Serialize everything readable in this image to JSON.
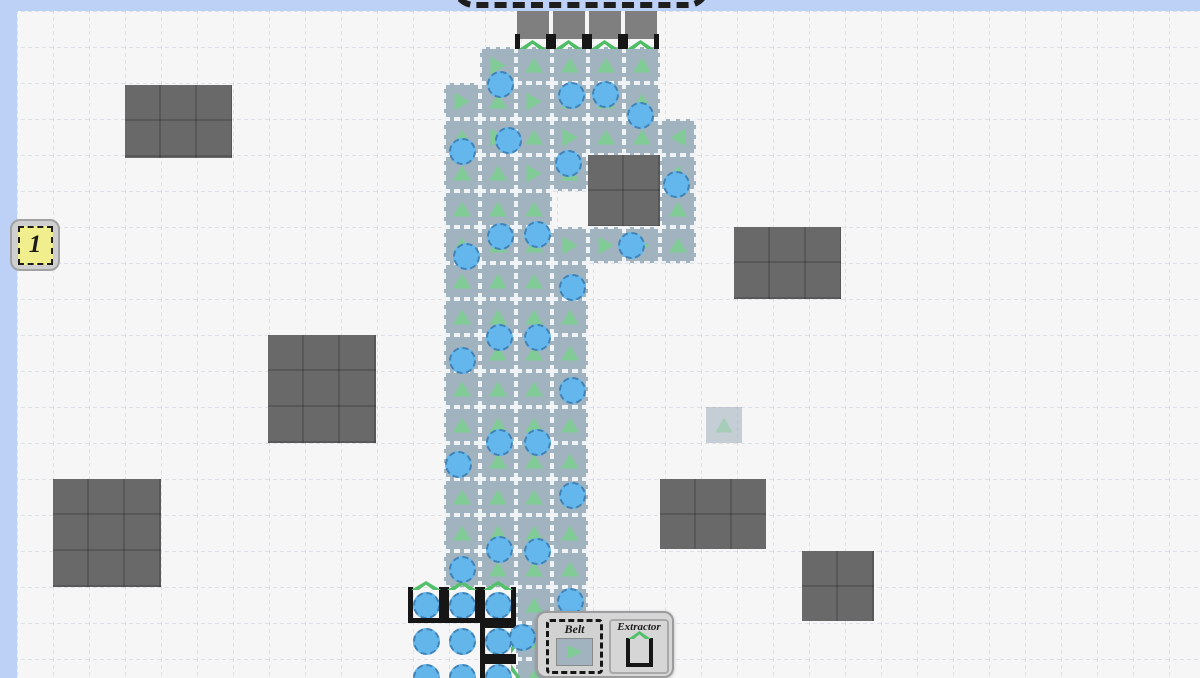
{
  "meta": {
    "tile_size": 36,
    "grid_origin_x": 17,
    "grid_origin_y": 11
  },
  "colors": {
    "margin_blue": "#bdd1f7",
    "field_bg": "#f6f6f7",
    "grid_line": "#c7cdd9",
    "belt": "#a0b3bf",
    "arrow_green": "#7ecd92",
    "item_blue": "#63b7ec",
    "obstacle_gray": "#696969",
    "port_gray": "#7f7f7f",
    "extractor_black": "#161616",
    "chevron_green": "#55c06b",
    "badge_yellow": "#f1ef8d"
  },
  "hud": {
    "level_badge": "1"
  },
  "toolbar": {
    "items": [
      {
        "label": "Belt",
        "selected": true,
        "icon": "belt-icon"
      },
      {
        "label": "Extractor",
        "selected": false,
        "icon": "extractor-icon"
      }
    ]
  },
  "hub": {
    "ports_x": [
      517,
      553,
      589,
      625
    ],
    "port_y": 11
  },
  "board": {
    "obstacles": [
      {
        "x": 125,
        "y": 85,
        "w": 107,
        "h": 73
      },
      {
        "x": 588,
        "y": 155,
        "w": 72,
        "h": 71
      },
      {
        "x": 734,
        "y": 227,
        "w": 107,
        "h": 72
      },
      {
        "x": 268,
        "y": 335,
        "w": 108,
        "h": 108
      },
      {
        "x": 53,
        "y": 479,
        "w": 108,
        "h": 108
      },
      {
        "x": 660,
        "y": 479,
        "w": 106,
        "h": 70
      },
      {
        "x": 802,
        "y": 551,
        "w": 72,
        "h": 70
      }
    ],
    "belts": [
      [
        480,
        47,
        "R"
      ],
      [
        516,
        47,
        "U"
      ],
      [
        552,
        47,
        "U"
      ],
      [
        588,
        47,
        "U"
      ],
      [
        624,
        47,
        "U"
      ],
      [
        444,
        83,
        "R"
      ],
      [
        480,
        83,
        "U"
      ],
      [
        516,
        83,
        "R"
      ],
      [
        552,
        83,
        "U"
      ],
      [
        588,
        83,
        "U"
      ],
      [
        624,
        83,
        "U"
      ],
      [
        444,
        119,
        "U"
      ],
      [
        480,
        119,
        "R"
      ],
      [
        516,
        119,
        "U"
      ],
      [
        552,
        119,
        "R"
      ],
      [
        588,
        119,
        "U"
      ],
      [
        624,
        119,
        "U"
      ],
      [
        660,
        119,
        "L"
      ],
      [
        444,
        155,
        "U"
      ],
      [
        480,
        155,
        "U"
      ],
      [
        516,
        155,
        "R"
      ],
      [
        552,
        155,
        "U"
      ],
      [
        660,
        155,
        "U"
      ],
      [
        444,
        191,
        "U"
      ],
      [
        480,
        191,
        "U"
      ],
      [
        516,
        191,
        "U"
      ],
      [
        660,
        191,
        "U"
      ],
      [
        444,
        227,
        "U"
      ],
      [
        480,
        227,
        "U"
      ],
      [
        516,
        227,
        "U"
      ],
      [
        552,
        227,
        "R"
      ],
      [
        588,
        227,
        "R"
      ],
      [
        624,
        227,
        "R"
      ],
      [
        660,
        227,
        "U"
      ],
      [
        444,
        263,
        "U"
      ],
      [
        480,
        263,
        "U"
      ],
      [
        516,
        263,
        "U"
      ],
      [
        552,
        263,
        "U"
      ],
      [
        444,
        299,
        "U"
      ],
      [
        480,
        299,
        "U"
      ],
      [
        516,
        299,
        "U"
      ],
      [
        552,
        299,
        "U"
      ],
      [
        444,
        335,
        "U"
      ],
      [
        480,
        335,
        "U"
      ],
      [
        516,
        335,
        "U"
      ],
      [
        552,
        335,
        "U"
      ],
      [
        444,
        371,
        "U"
      ],
      [
        480,
        371,
        "U"
      ],
      [
        516,
        371,
        "U"
      ],
      [
        552,
        371,
        "U"
      ],
      [
        444,
        407,
        "U"
      ],
      [
        480,
        407,
        "U"
      ],
      [
        516,
        407,
        "U"
      ],
      [
        552,
        407,
        "U"
      ],
      [
        444,
        443,
        "U"
      ],
      [
        480,
        443,
        "U"
      ],
      [
        516,
        443,
        "U"
      ],
      [
        552,
        443,
        "U"
      ],
      [
        444,
        479,
        "U"
      ],
      [
        480,
        479,
        "U"
      ],
      [
        516,
        479,
        "U"
      ],
      [
        552,
        479,
        "U"
      ],
      [
        444,
        515,
        "U"
      ],
      [
        480,
        515,
        "U"
      ],
      [
        516,
        515,
        "U"
      ],
      [
        552,
        515,
        "U"
      ],
      [
        444,
        551,
        "U"
      ],
      [
        480,
        551,
        "U"
      ],
      [
        516,
        551,
        "U"
      ],
      [
        552,
        551,
        "U"
      ],
      [
        516,
        587,
        "U"
      ],
      [
        552,
        587,
        "U"
      ],
      [
        516,
        623,
        "U"
      ],
      [
        552,
        623,
        "U"
      ],
      [
        516,
        659,
        "U"
      ],
      [
        552,
        659,
        "U"
      ]
    ],
    "items": [
      {
        "x": 500,
        "y": 84
      },
      {
        "x": 571,
        "y": 95
      },
      {
        "x": 605,
        "y": 94
      },
      {
        "x": 640,
        "y": 115
      },
      {
        "x": 508,
        "y": 140
      },
      {
        "x": 462,
        "y": 151
      },
      {
        "x": 568,
        "y": 163
      },
      {
        "x": 676,
        "y": 184
      },
      {
        "x": 631,
        "y": 245
      },
      {
        "x": 466,
        "y": 256
      },
      {
        "x": 500,
        "y": 236
      },
      {
        "x": 537,
        "y": 234
      },
      {
        "x": 572,
        "y": 287
      },
      {
        "x": 462,
        "y": 360
      },
      {
        "x": 499,
        "y": 337
      },
      {
        "x": 537,
        "y": 337
      },
      {
        "x": 572,
        "y": 390
      },
      {
        "x": 499,
        "y": 442
      },
      {
        "x": 537,
        "y": 442
      },
      {
        "x": 458,
        "y": 464
      },
      {
        "x": 572,
        "y": 495
      },
      {
        "x": 462,
        "y": 569
      },
      {
        "x": 499,
        "y": 549
      },
      {
        "x": 537,
        "y": 551
      },
      {
        "x": 570,
        "y": 601
      },
      {
        "x": 522,
        "y": 637
      }
    ],
    "resources": [
      {
        "x": 426,
        "y": 605
      },
      {
        "x": 462,
        "y": 605
      },
      {
        "x": 498,
        "y": 605
      },
      {
        "x": 426,
        "y": 641
      },
      {
        "x": 462,
        "y": 641
      },
      {
        "x": 498,
        "y": 641
      },
      {
        "x": 426,
        "y": 677
      },
      {
        "x": 462,
        "y": 677
      },
      {
        "x": 498,
        "y": 677
      }
    ],
    "extractors": [
      {
        "x": 408,
        "y": 587,
        "dir": "U"
      },
      {
        "x": 444,
        "y": 587,
        "dir": "U"
      },
      {
        "x": 480,
        "y": 587,
        "dir": "U"
      },
      {
        "x": 480,
        "y": 623,
        "dir": "R"
      },
      {
        "x": 480,
        "y": 659,
        "dir": "R"
      }
    ],
    "ghost": {
      "x": 706,
      "y": 407
    }
  }
}
